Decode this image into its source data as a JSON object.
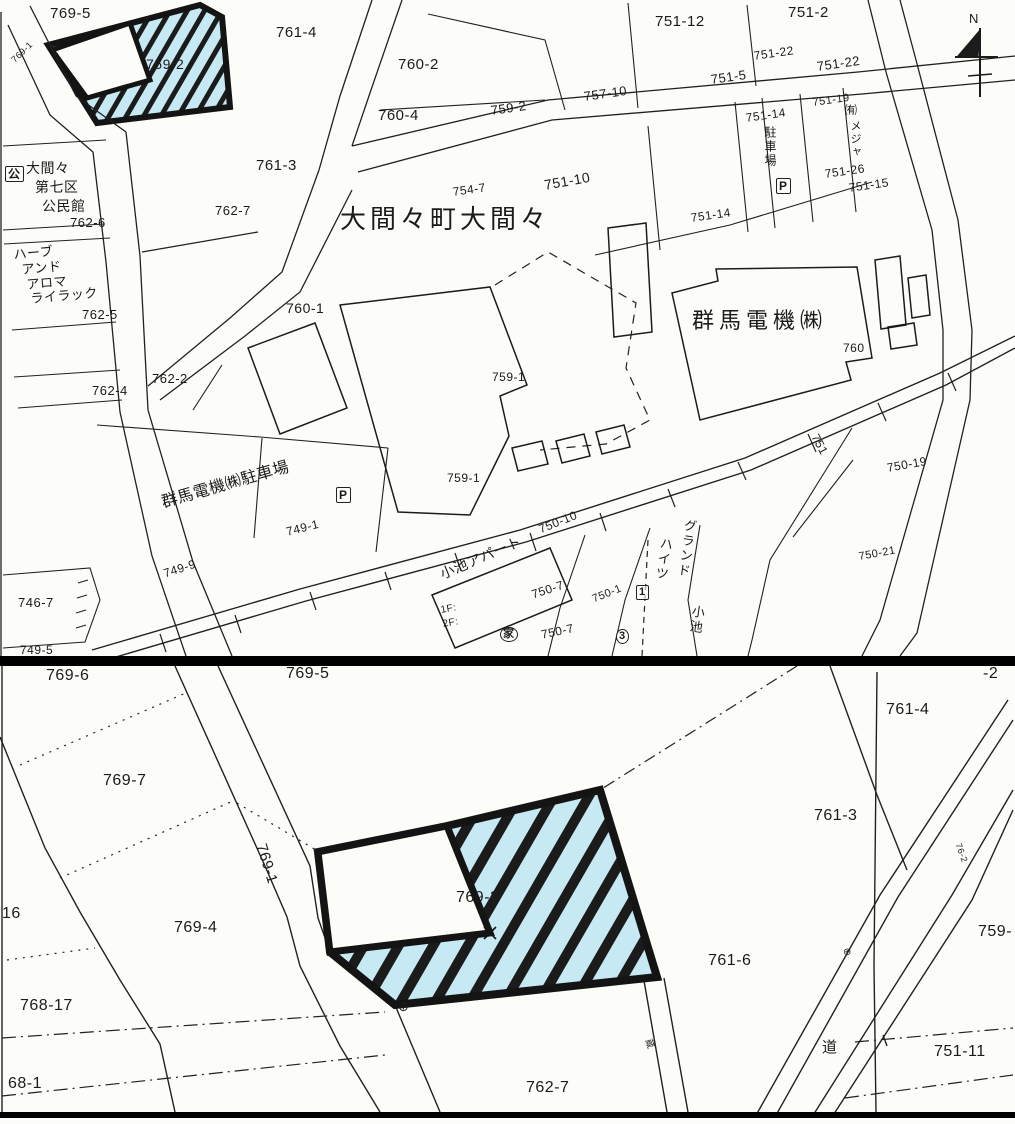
{
  "meta": {
    "map_kind": "cadastral parcel map",
    "highlight_fill": "#c7e9f4",
    "line_color": "#212121",
    "divider_color": "#000000",
    "highlighted_parcel": "769-2"
  },
  "north": {
    "label": "N"
  },
  "top_map": {
    "labels": [
      {
        "t": "769-5",
        "x": 50,
        "y": 6,
        "fs": 15
      },
      {
        "t": "769-2",
        "x": 146,
        "y": 57,
        "fs": 14
      },
      {
        "t": "769-1",
        "x": 10,
        "y": 58,
        "fs": 9,
        "r": -44
      },
      {
        "t": "761-4",
        "x": 276,
        "y": 25,
        "fs": 15
      },
      {
        "t": "760-2",
        "x": 398,
        "y": 57,
        "fs": 15
      },
      {
        "t": "751-12",
        "x": 655,
        "y": 14,
        "fs": 15
      },
      {
        "t": "751-2",
        "x": 788,
        "y": 5,
        "fs": 15
      },
      {
        "t": "751-22",
        "x": 753,
        "y": 50,
        "fs": 12,
        "r": -8
      },
      {
        "t": "751-22",
        "x": 816,
        "y": 60,
        "fs": 13,
        "r": -8
      },
      {
        "t": "751-5",
        "x": 710,
        "y": 73,
        "fs": 13,
        "r": -8
      },
      {
        "t": "757-10",
        "x": 583,
        "y": 90,
        "fs": 13,
        "r": -8
      },
      {
        "t": "760-4",
        "x": 378,
        "y": 108,
        "fs": 15
      },
      {
        "t": "759-2",
        "x": 490,
        "y": 104,
        "fs": 13,
        "r": -8
      },
      {
        "t": "751-14",
        "x": 745,
        "y": 112,
        "fs": 12,
        "r": -8
      },
      {
        "t": "751-19",
        "x": 812,
        "y": 98,
        "fs": 11,
        "r": -8
      },
      {
        "t": "㈲",
        "x": 845,
        "y": 104,
        "fs": 12
      },
      {
        "t": "メジャ",
        "x": 849,
        "y": 120,
        "fs": 11,
        "v": 1
      },
      {
        "t": "駐車場",
        "x": 764,
        "y": 126,
        "fs": 12,
        "v": 1
      },
      {
        "t": "P",
        "x": 776,
        "y": 178,
        "fs": 12,
        "k": "box",
        "n": "parking-icon"
      },
      {
        "t": "751-26",
        "x": 824,
        "y": 168,
        "fs": 12,
        "r": -8
      },
      {
        "t": "751-15",
        "x": 848,
        "y": 182,
        "fs": 12,
        "r": -8
      },
      {
        "t": "751-14",
        "x": 690,
        "y": 212,
        "fs": 12,
        "r": -8
      },
      {
        "t": "761-3",
        "x": 256,
        "y": 158,
        "fs": 15
      },
      {
        "t": "762-7",
        "x": 215,
        "y": 204,
        "fs": 13
      },
      {
        "t": "公",
        "x": 5,
        "y": 166,
        "fs": 12,
        "k": "box",
        "n": "public-hall-icon"
      },
      {
        "t": "大間々",
        "x": 26,
        "y": 161,
        "fs": 14
      },
      {
        "t": "第七区",
        "x": 35,
        "y": 180,
        "fs": 14
      },
      {
        "t": "公民館",
        "x": 42,
        "y": 199,
        "fs": 14
      },
      {
        "t": "762-6",
        "x": 70,
        "y": 216,
        "fs": 13
      },
      {
        "t": "ハーブ",
        "x": 13,
        "y": 248,
        "fs": 13,
        "r": -5
      },
      {
        "t": "アンド",
        "x": 21,
        "y": 263,
        "fs": 13,
        "r": -5
      },
      {
        "t": "アロマ",
        "x": 26,
        "y": 278,
        "fs": 13,
        "r": -5
      },
      {
        "t": "ライラック",
        "x": 30,
        "y": 292,
        "fs": 13,
        "r": -5
      },
      {
        "t": "762-5",
        "x": 82,
        "y": 308,
        "fs": 13
      },
      {
        "t": "762-4",
        "x": 92,
        "y": 384,
        "fs": 13
      },
      {
        "t": "762-2",
        "x": 152,
        "y": 372,
        "fs": 13
      },
      {
        "t": "746-7",
        "x": 18,
        "y": 596,
        "fs": 13
      },
      {
        "t": "749-5",
        "x": 20,
        "y": 644,
        "fs": 12
      },
      {
        "t": "大間々町大間々",
        "x": 340,
        "y": 206,
        "fs": 26,
        "ls": 4,
        "n": "place-name-title"
      },
      {
        "t": "754-7",
        "x": 452,
        "y": 186,
        "fs": 12,
        "r": -8
      },
      {
        "t": "751-10",
        "x": 543,
        "y": 178,
        "fs": 14,
        "r": -10
      },
      {
        "t": "760-1",
        "x": 286,
        "y": 301,
        "fs": 14
      },
      {
        "t": "群馬電機㈱",
        "x": 692,
        "y": 310,
        "fs": 22,
        "ls": 5,
        "n": "company-name"
      },
      {
        "t": "760",
        "x": 843,
        "y": 342,
        "fs": 12
      },
      {
        "t": "759-1",
        "x": 492,
        "y": 371,
        "fs": 12
      },
      {
        "t": "759-1",
        "x": 447,
        "y": 472,
        "fs": 12
      },
      {
        "t": "群馬電機㈱駐車場",
        "x": 160,
        "y": 496,
        "fs": 16,
        "r": -16,
        "n": "parking-lot-name"
      },
      {
        "t": "P",
        "x": 336,
        "y": 487,
        "fs": 12,
        "k": "box",
        "n": "parking-icon"
      },
      {
        "t": "749-1",
        "x": 285,
        "y": 526,
        "fs": 12,
        "r": -14
      },
      {
        "t": "749-9",
        "x": 162,
        "y": 568,
        "fs": 12,
        "r": -18
      },
      {
        "t": "小池アパート",
        "x": 438,
        "y": 568,
        "fs": 14,
        "r": -23,
        "n": "apartment-name"
      },
      {
        "t": "1F:",
        "x": 440,
        "y": 606,
        "fs": 10,
        "r": -10
      },
      {
        "t": "2F:",
        "x": 442,
        "y": 620,
        "fs": 10,
        "r": -10
      },
      {
        "t": "750-10",
        "x": 537,
        "y": 524,
        "fs": 12,
        "r": -22
      },
      {
        "t": "750-7",
        "x": 530,
        "y": 589,
        "fs": 12,
        "r": -18
      },
      {
        "t": "750-7",
        "x": 540,
        "y": 629,
        "fs": 12,
        "r": -12
      },
      {
        "t": "750-1",
        "x": 591,
        "y": 595,
        "fs": 11,
        "r": -22
      },
      {
        "t": "1",
        "x": 636,
        "y": 585,
        "fs": 11,
        "k": "box",
        "n": "marker-box-1"
      },
      {
        "t": "3",
        "x": 616,
        "y": 629,
        "fs": 11,
        "k": "circle",
        "n": "marker-circle-3"
      },
      {
        "t": "家",
        "x": 500,
        "y": 627,
        "fs": 11,
        "k": "circle",
        "n": "marker-circle-house"
      },
      {
        "t": "グランド",
        "x": 684,
        "y": 518,
        "fs": 13,
        "v": 1,
        "r": 8,
        "n": "building-name"
      },
      {
        "t": "ハイツ",
        "x": 660,
        "y": 536,
        "fs": 13,
        "v": 1,
        "r": 8,
        "n": "building-name"
      },
      {
        "t": "小池",
        "x": 692,
        "y": 604,
        "fs": 13,
        "v": 1,
        "r": 8,
        "n": "building-name"
      },
      {
        "t": "751",
        "x": 820,
        "y": 432,
        "fs": 12,
        "r": 62
      },
      {
        "t": "750-19",
        "x": 886,
        "y": 462,
        "fs": 12,
        "r": -10
      },
      {
        "t": "750-21",
        "x": 858,
        "y": 552,
        "fs": 11,
        "r": -10
      },
      {
        "t": "N",
        "x": 969,
        "y": 12,
        "fs": 13,
        "n": "north-label"
      }
    ]
  },
  "bottom_map": {
    "labels": [
      {
        "t": "769-6",
        "x": 46,
        "y": 2,
        "fs": 16
      },
      {
        "t": "769-5",
        "x": 286,
        "y": 0,
        "fs": 16
      },
      {
        "t": "-2",
        "x": 983,
        "y": 0,
        "fs": 16
      },
      {
        "t": "769-7",
        "x": 103,
        "y": 107,
        "fs": 16
      },
      {
        "t": "761-4",
        "x": 886,
        "y": 36,
        "fs": 16
      },
      {
        "t": "769-1",
        "x": 268,
        "y": 176,
        "fs": 15,
        "r": 73
      },
      {
        "t": "761-3",
        "x": 814,
        "y": 142,
        "fs": 16
      },
      {
        "t": "769-2",
        "x": 456,
        "y": 224,
        "fs": 16,
        "n": "highlighted-parcel-label"
      },
      {
        "t": "16",
        "x": 2,
        "y": 240,
        "fs": 16
      },
      {
        "t": "769-4",
        "x": 174,
        "y": 254,
        "fs": 16
      },
      {
        "t": "761-6",
        "x": 708,
        "y": 287,
        "fs": 16
      },
      {
        "t": "759-",
        "x": 978,
        "y": 258,
        "fs": 16
      },
      {
        "t": "768-17",
        "x": 20,
        "y": 332,
        "fs": 16
      },
      {
        "t": "751-11",
        "x": 934,
        "y": 378,
        "fs": 16
      },
      {
        "t": "道",
        "x": 822,
        "y": 374,
        "fs": 15,
        "n": "road-label"
      },
      {
        "t": "68-1",
        "x": 8,
        "y": 410,
        "fs": 16
      },
      {
        "t": "762-7",
        "x": 526,
        "y": 414,
        "fs": 16
      },
      {
        "t": "⊕",
        "x": 398,
        "y": 334,
        "fs": 13,
        "n": "survey-mark-icon"
      },
      {
        "t": "⊕",
        "x": 843,
        "y": 282,
        "fs": 10,
        "n": "survey-mark-icon"
      },
      {
        "t": "76-2",
        "x": 962,
        "y": 176,
        "fs": 9,
        "r": 70
      },
      {
        "t": "蔵",
        "x": 652,
        "y": 372,
        "fs": 9,
        "r": 70
      }
    ]
  }
}
